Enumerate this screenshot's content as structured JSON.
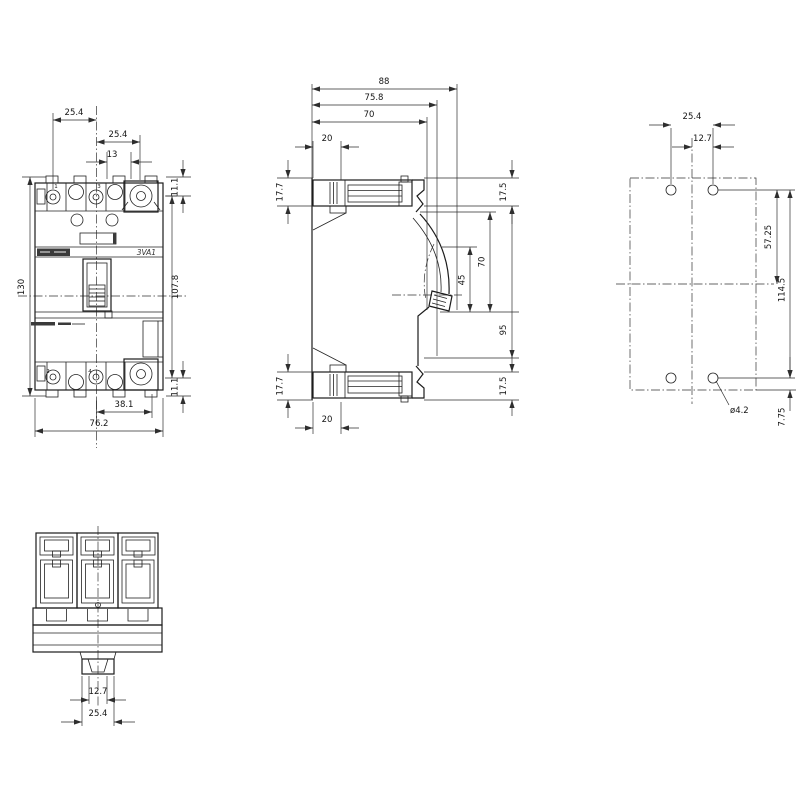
{
  "drawing": {
    "type": "technical-dimension-drawing",
    "product_label": "3VA1",
    "front": {
      "terminals": {
        "n1": "1",
        "n3": "3",
        "n2": "2",
        "n4": "4"
      },
      "dims": {
        "p1": "25.4",
        "p2": "25.4",
        "w13": "13",
        "t111": "11.1",
        "h130": "130",
        "m1078": "107.8",
        "b111": "11.1",
        "w381": "38.1",
        "w762": "76.2"
      }
    },
    "side": {
      "dims": {
        "d88": "88",
        "d758": "75.8",
        "d70t": "70",
        "d20t": "20",
        "h177t": "17.7",
        "z175t": "17.5",
        "d70r": "70",
        "d45": "45",
        "d95": "95",
        "z175b": "17.5",
        "h177b": "17.7",
        "d20b": "20"
      }
    },
    "drill": {
      "dims": {
        "p254": "25.4",
        "p127": "12.7",
        "v5725": "57.25",
        "v1145": "114.5",
        "dia": "ø4.2",
        "e775": "7.75"
      }
    },
    "bottom": {
      "dims": {
        "i127": "12.7",
        "o254": "25.4"
      }
    }
  }
}
